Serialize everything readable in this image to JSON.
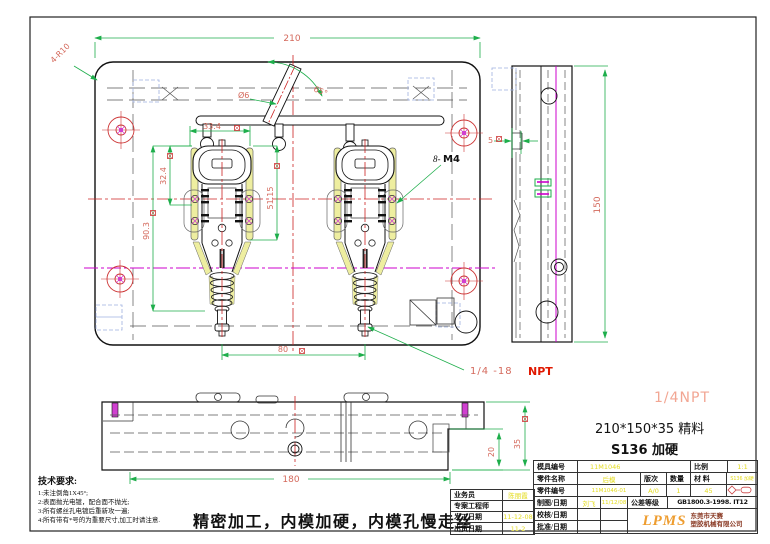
{
  "drawing": {
    "dims": {
      "width_top": "210",
      "corner": "4-R10",
      "angle": "65°",
      "sprue_dia": "Ø6",
      "cavity_width": "33.4",
      "head_height": "32.4",
      "screw_span": "51.15",
      "cavity_height": "90.3",
      "edge_gap": "5",
      "pitch": "80",
      "side_height": "150",
      "bottom_width": "180",
      "step_depth": "20",
      "plate_thickness": "35"
    },
    "labels": {
      "thread_callout_prefix": "8-",
      "thread_callout": "M4",
      "npt_leader": "1/4 -18",
      "npt_word": "NPT",
      "npt_side": "1/4NPT",
      "spec_size": "210*150*35  精料",
      "spec_material": "S136 加硬"
    }
  },
  "notes": {
    "title": "技术要求:",
    "items": [
      "1:未注倒角1X45°;",
      "2:表面抛光电镀，配合面不抛光;",
      "3:所有螺丝孔电镀后重新攻一遍;",
      "4:所有带有*号的为重要尺寸,加工时请注意."
    ],
    "process": "精密加工，内模加硬，内模孔慢走丝"
  },
  "left_table": {
    "rows": [
      {
        "label": "业务员",
        "value": "陈丽霞"
      },
      {
        "label": "专案工程师",
        "value": ""
      },
      {
        "label": "发工日期",
        "value": "11-12-08"
      },
      {
        "label": "出货日期",
        "value": "11-2"
      }
    ]
  },
  "title_block": {
    "mold_no_label": "模具编号",
    "mold_no": "11M1046",
    "scale_label": "比例",
    "scale": "1:1",
    "part_name_label": "零件名称",
    "part_name": "后模",
    "rev_label": "版次",
    "qty_label": "数量",
    "mat_label": "材 料",
    "mat_note": "S136 加硬",
    "part_no_label": "零件编号",
    "part_no": "11M1046-01",
    "rev": "A/0",
    "qty": "1",
    "mat": "45",
    "draw_label": "制图/日期",
    "draw_name": "刘飞",
    "draw_date": "11/12/08",
    "tol_label": "公差等级",
    "tol_value": "GB1800.3-1998. IT12",
    "check_label": "校核/日期",
    "approve_label": "批准/日期",
    "logo": "LPMS",
    "company_line1": "东莞市天赛",
    "company_line2": "塑胶机械有限公司"
  },
  "colors": {
    "dim_line_green": "#1eae4b",
    "dim_text_red": "#d4695c",
    "centerline_red": "#cc2222",
    "centerline_magenta": "#cc00cc",
    "highlight_yellow": "#eeeea0",
    "table_value_yellow": "#e4dc1e",
    "npt_red": "#e01800",
    "npt_side_pink": "#f2a693",
    "logo_orange": "#ee9d30",
    "ghost_blue": "#9fb0e0"
  }
}
